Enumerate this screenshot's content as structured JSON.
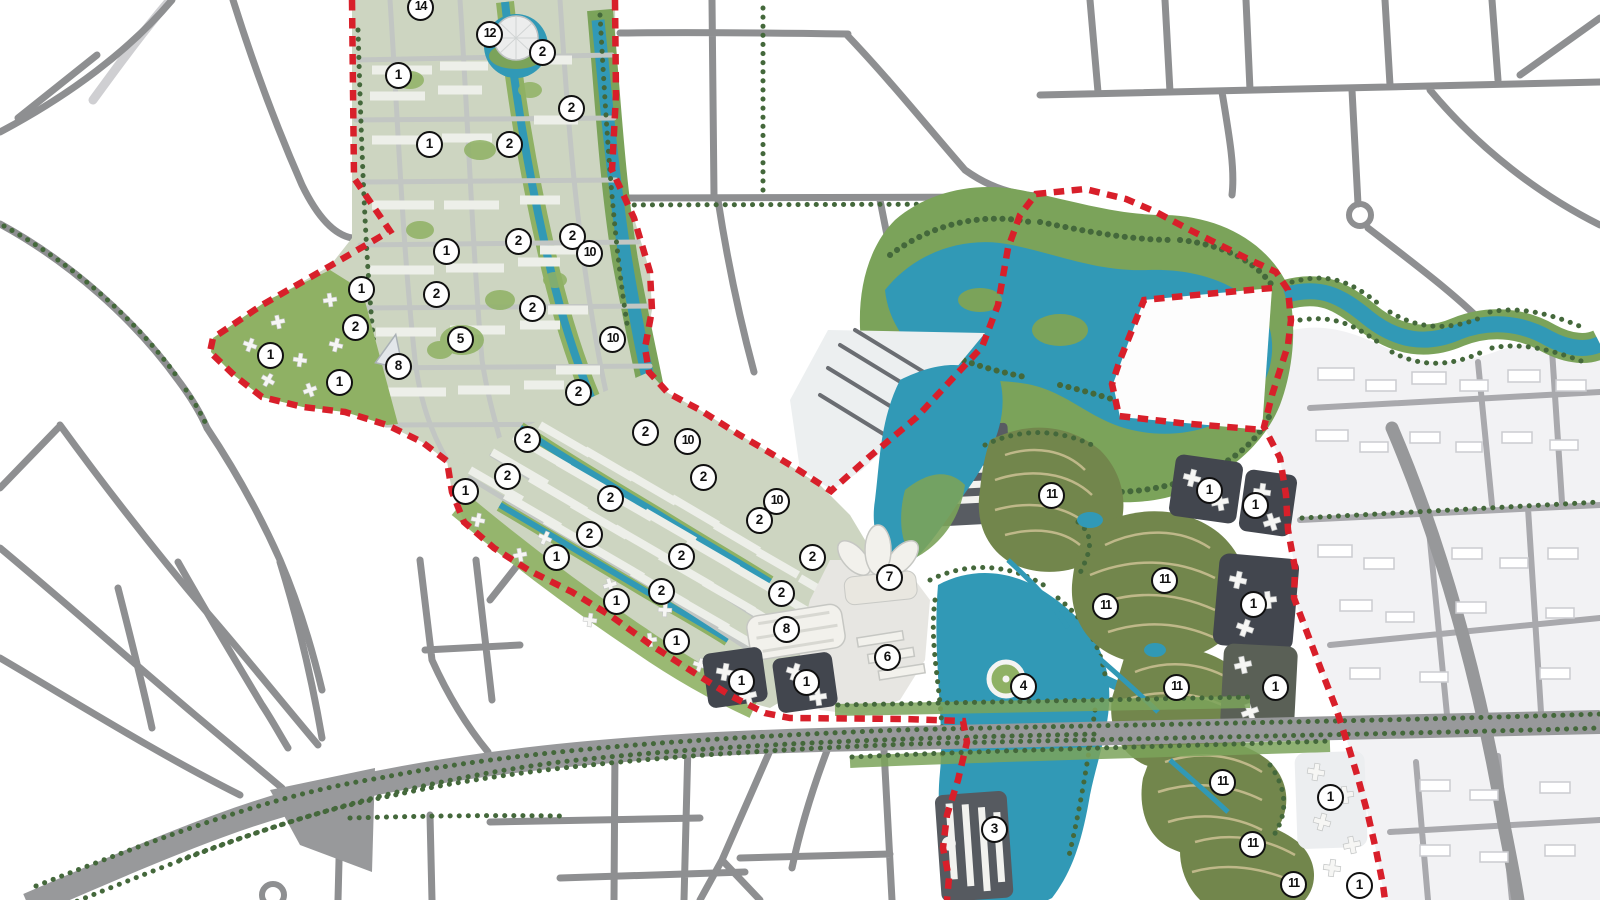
{
  "map": {
    "kind": "urban-masterplan-rendering",
    "visible_text_note": "only numeric zone badges are rendered on the plan"
  },
  "colors": {
    "boundary": "#d81f2a",
    "water": "#3199b6",
    "park": "#7ba35a",
    "tree": "#44683b",
    "fabric": "#cdd5c1",
    "block_green": "#8fb164",
    "bldg": "#edefe9",
    "villa": "#72864c",
    "villa_row": "#c8be90",
    "dark_base": "#42464e",
    "pale": "#f2f2f4",
    "road": "#8e8f91",
    "road_lt": "#c2c6c3",
    "blvd": "#98999b",
    "marker_bg": "#ffffff",
    "marker_border": "#101010"
  },
  "landmark_icons": [
    {
      "name": "geodesic-dome-icon",
      "x": 516,
      "y": 38
    },
    {
      "name": "pyramid-building-icon",
      "x": 392,
      "y": 352
    },
    {
      "name": "lotus-building-icon",
      "x": 878,
      "y": 562
    },
    {
      "name": "convention-hall-icon",
      "x": 795,
      "y": 632
    },
    {
      "name": "ferris-plaza-icon",
      "x": 1006,
      "y": 679
    }
  ],
  "markers": [
    {
      "label": "14",
      "x": 421,
      "y": 8
    },
    {
      "label": "12",
      "x": 490,
      "y": 35
    },
    {
      "label": "2",
      "x": 543,
      "y": 53
    },
    {
      "label": "1",
      "x": 399,
      "y": 76
    },
    {
      "label": "2",
      "x": 572,
      "y": 109
    },
    {
      "label": "1",
      "x": 430,
      "y": 145
    },
    {
      "label": "2",
      "x": 510,
      "y": 145
    },
    {
      "label": "2",
      "x": 519,
      "y": 242
    },
    {
      "label": "2",
      "x": 573,
      "y": 237
    },
    {
      "label": "10",
      "x": 590,
      "y": 254
    },
    {
      "label": "1",
      "x": 447,
      "y": 252
    },
    {
      "label": "1",
      "x": 362,
      "y": 290
    },
    {
      "label": "2",
      "x": 437,
      "y": 295
    },
    {
      "label": "2",
      "x": 533,
      "y": 309
    },
    {
      "label": "10",
      "x": 613,
      "y": 340
    },
    {
      "label": "2",
      "x": 356,
      "y": 328
    },
    {
      "label": "5",
      "x": 461,
      "y": 340
    },
    {
      "label": "1",
      "x": 271,
      "y": 356
    },
    {
      "label": "8",
      "x": 399,
      "y": 367
    },
    {
      "label": "1",
      "x": 340,
      "y": 383
    },
    {
      "label": "2",
      "x": 579,
      "y": 393
    },
    {
      "label": "2",
      "x": 528,
      "y": 440
    },
    {
      "label": "2",
      "x": 646,
      "y": 433
    },
    {
      "label": "10",
      "x": 688,
      "y": 442
    },
    {
      "label": "2",
      "x": 508,
      "y": 477
    },
    {
      "label": "1",
      "x": 466,
      "y": 492
    },
    {
      "label": "2",
      "x": 704,
      "y": 478
    },
    {
      "label": "2",
      "x": 611,
      "y": 499
    },
    {
      "label": "10",
      "x": 777,
      "y": 502
    },
    {
      "label": "2",
      "x": 760,
      "y": 521
    },
    {
      "label": "2",
      "x": 590,
      "y": 535
    },
    {
      "label": "1",
      "x": 557,
      "y": 558
    },
    {
      "label": "2",
      "x": 682,
      "y": 557
    },
    {
      "label": "2",
      "x": 813,
      "y": 558
    },
    {
      "label": "2",
      "x": 662,
      "y": 592
    },
    {
      "label": "1",
      "x": 617,
      "y": 602
    },
    {
      "label": "2",
      "x": 782,
      "y": 594
    },
    {
      "label": "7",
      "x": 890,
      "y": 578
    },
    {
      "label": "8",
      "x": 787,
      "y": 630
    },
    {
      "label": "1",
      "x": 677,
      "y": 642
    },
    {
      "label": "6",
      "x": 888,
      "y": 658
    },
    {
      "label": "1",
      "x": 742,
      "y": 682
    },
    {
      "label": "1",
      "x": 807,
      "y": 683
    },
    {
      "label": "4",
      "x": 1024,
      "y": 687
    },
    {
      "label": "11",
      "x": 1052,
      "y": 496
    },
    {
      "label": "1",
      "x": 1210,
      "y": 491
    },
    {
      "label": "1",
      "x": 1256,
      "y": 506
    },
    {
      "label": "11",
      "x": 1165,
      "y": 581
    },
    {
      "label": "11",
      "x": 1106,
      "y": 607
    },
    {
      "label": "1",
      "x": 1254,
      "y": 605
    },
    {
      "label": "11",
      "x": 1177,
      "y": 688
    },
    {
      "label": "1",
      "x": 1276,
      "y": 688
    },
    {
      "label": "3",
      "x": 995,
      "y": 830
    },
    {
      "label": "11",
      "x": 1223,
      "y": 783
    },
    {
      "label": "1",
      "x": 1331,
      "y": 798
    },
    {
      "label": "11",
      "x": 1253,
      "y": 845
    },
    {
      "label": "11",
      "x": 1294,
      "y": 885
    },
    {
      "label": "1",
      "x": 1360,
      "y": 886
    }
  ]
}
